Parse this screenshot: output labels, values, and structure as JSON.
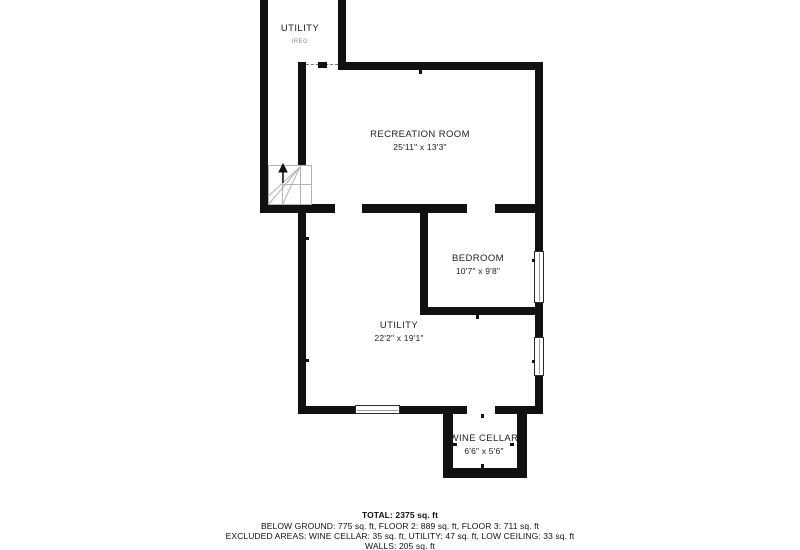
{
  "plan": {
    "rooms": {
      "utility_top": {
        "label": "UTILITY",
        "note": "IREG"
      },
      "recreation": {
        "label": "RECREATION ROOM",
        "dims": "25'11\" x 13'3\""
      },
      "bedroom": {
        "label": "BEDROOM",
        "dims": "10'7\" x 9'8\""
      },
      "utility": {
        "label": "UTILITY",
        "dims": "22'2\" x 19'1\""
      },
      "wine_cellar": {
        "label": "WINE CELLAR",
        "dims": "6'6\" x 5'6\""
      }
    },
    "summary": {
      "total": "TOTAL: 2375 sq. ft",
      "floors": "BELOW GROUND: 775 sq. ft, FLOOR 2: 889 sq. ft, FLOOR 3: 711 sq. ft",
      "excluded": "EXCLUDED AREAS: WINE CELLAR: 35 sq. ft, UTILITY: 47 sq. ft, LOW CEILING: 33 sq. ft",
      "walls": "WALLS: 205 sq. ft"
    },
    "colors": {
      "wall": "#111111",
      "stairs": "#b3b3b3",
      "text": "#1a1a1a",
      "note_text": "#8a8a8a"
    }
  }
}
